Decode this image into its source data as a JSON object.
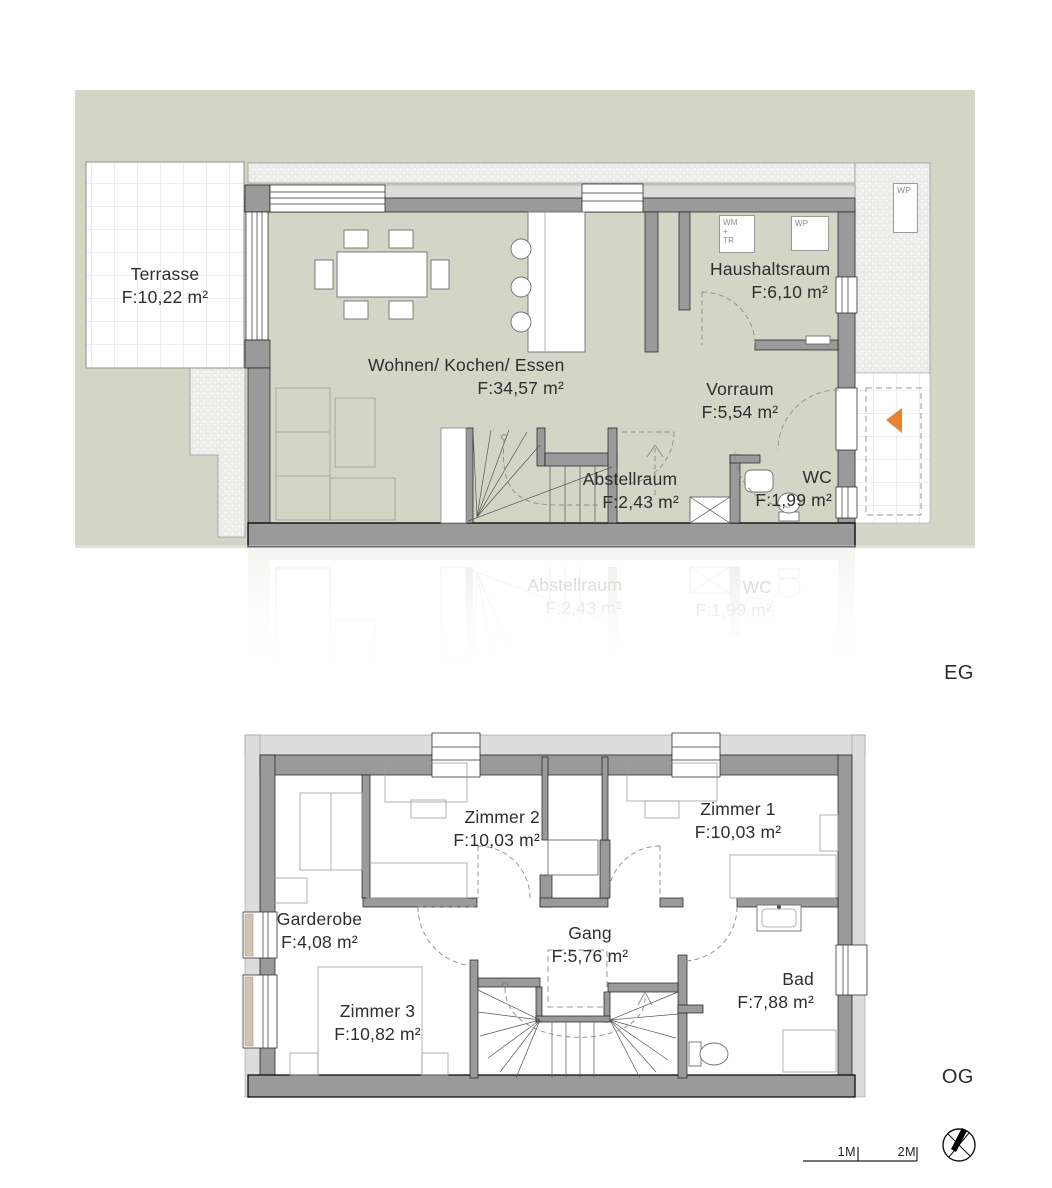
{
  "colors": {
    "site_green": "#D3D6C7",
    "wall_gray": "#9A9A9A",
    "wall_light": "#DCDCDC",
    "accent_orange": "#E8822F",
    "window_sill_tan": "#D2C3B2"
  },
  "eg": {
    "floor_label": "EG",
    "rooms": {
      "terrasse": {
        "name": "Terrasse",
        "area": "F:10,22 m²"
      },
      "wohnen": {
        "name": "Wohnen/ Kochen/ Essen",
        "area": "F:34,57 m²"
      },
      "haushaltsraum": {
        "name": "Haushaltsraum",
        "area": "F:6,10 m²"
      },
      "vorraum": {
        "name": "Vorraum",
        "area": "F:5,54 m²"
      },
      "abstellraum": {
        "name": "Abstellraum",
        "area": "F:2,43 m²"
      },
      "wc": {
        "name": "WC",
        "area": "F:1,99 m²"
      }
    },
    "appliances": {
      "washer_dryer": "WM\n+\nTR",
      "heat_pump_inside": "WP",
      "heat_pump_outside": "WP"
    }
  },
  "ghost": {
    "abstellraum": {
      "name": "Abstellraum",
      "area": "F:2,43 m²"
    },
    "wc": {
      "name": "WC",
      "area": "F:1,99 m²"
    }
  },
  "og": {
    "floor_label": "OG",
    "rooms": {
      "zimmer2": {
        "name": "Zimmer 2",
        "area": "F:10,03 m²"
      },
      "zimmer1": {
        "name": "Zimmer 1",
        "area": "F:10,03 m²"
      },
      "garderobe": {
        "name": "Garderobe",
        "area": "F:4,08 m²"
      },
      "gang": {
        "name": "Gang",
        "area": "F:5,76 m²"
      },
      "zimmer3": {
        "name": "Zimmer 3",
        "area": "F:10,82 m²"
      },
      "bad": {
        "name": "Bad",
        "area": "F:7,88 m²"
      }
    }
  },
  "scalebar": {
    "tick1": "1M",
    "tick2": "2M"
  }
}
